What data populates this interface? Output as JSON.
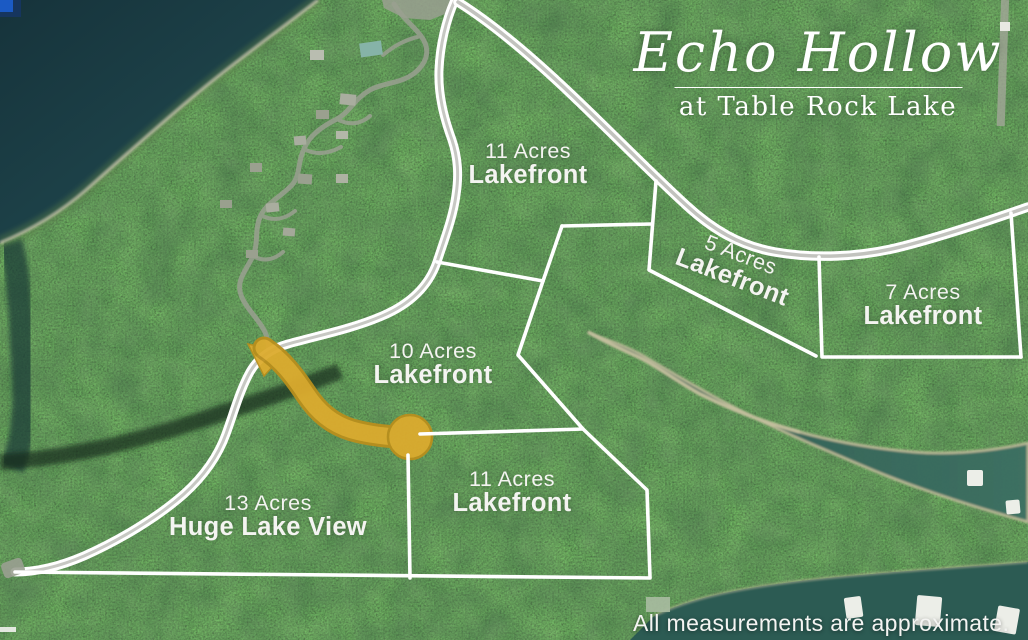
{
  "title": {
    "main": "Echo Hollow",
    "sub": "at Table Rock Lake"
  },
  "lots": [
    {
      "id": "lot-11-north",
      "acres": "11 Acres",
      "label": "Lakefront"
    },
    {
      "id": "lot-5",
      "acres": "5 Acres",
      "label": "Lakefront"
    },
    {
      "id": "lot-7",
      "acres": "7 Acres",
      "label": "Lakefront"
    },
    {
      "id": "lot-10",
      "acres": "10 Acres",
      "label": "Lakefront"
    },
    {
      "id": "lot-11-south",
      "acres": "11 Acres",
      "label": "Lakefront"
    },
    {
      "id": "lot-13",
      "acres": "13 Acres",
      "label": "Huge Lake View"
    }
  ],
  "disclaimer": "All measurements are approximate.",
  "colors": {
    "boundary_line": "#ffffff",
    "new_road_highlight": "#dcab2e",
    "lake_water_dark": "#1a3d45",
    "cove_water": "#33605a",
    "forest_green": "#2a4a24"
  }
}
